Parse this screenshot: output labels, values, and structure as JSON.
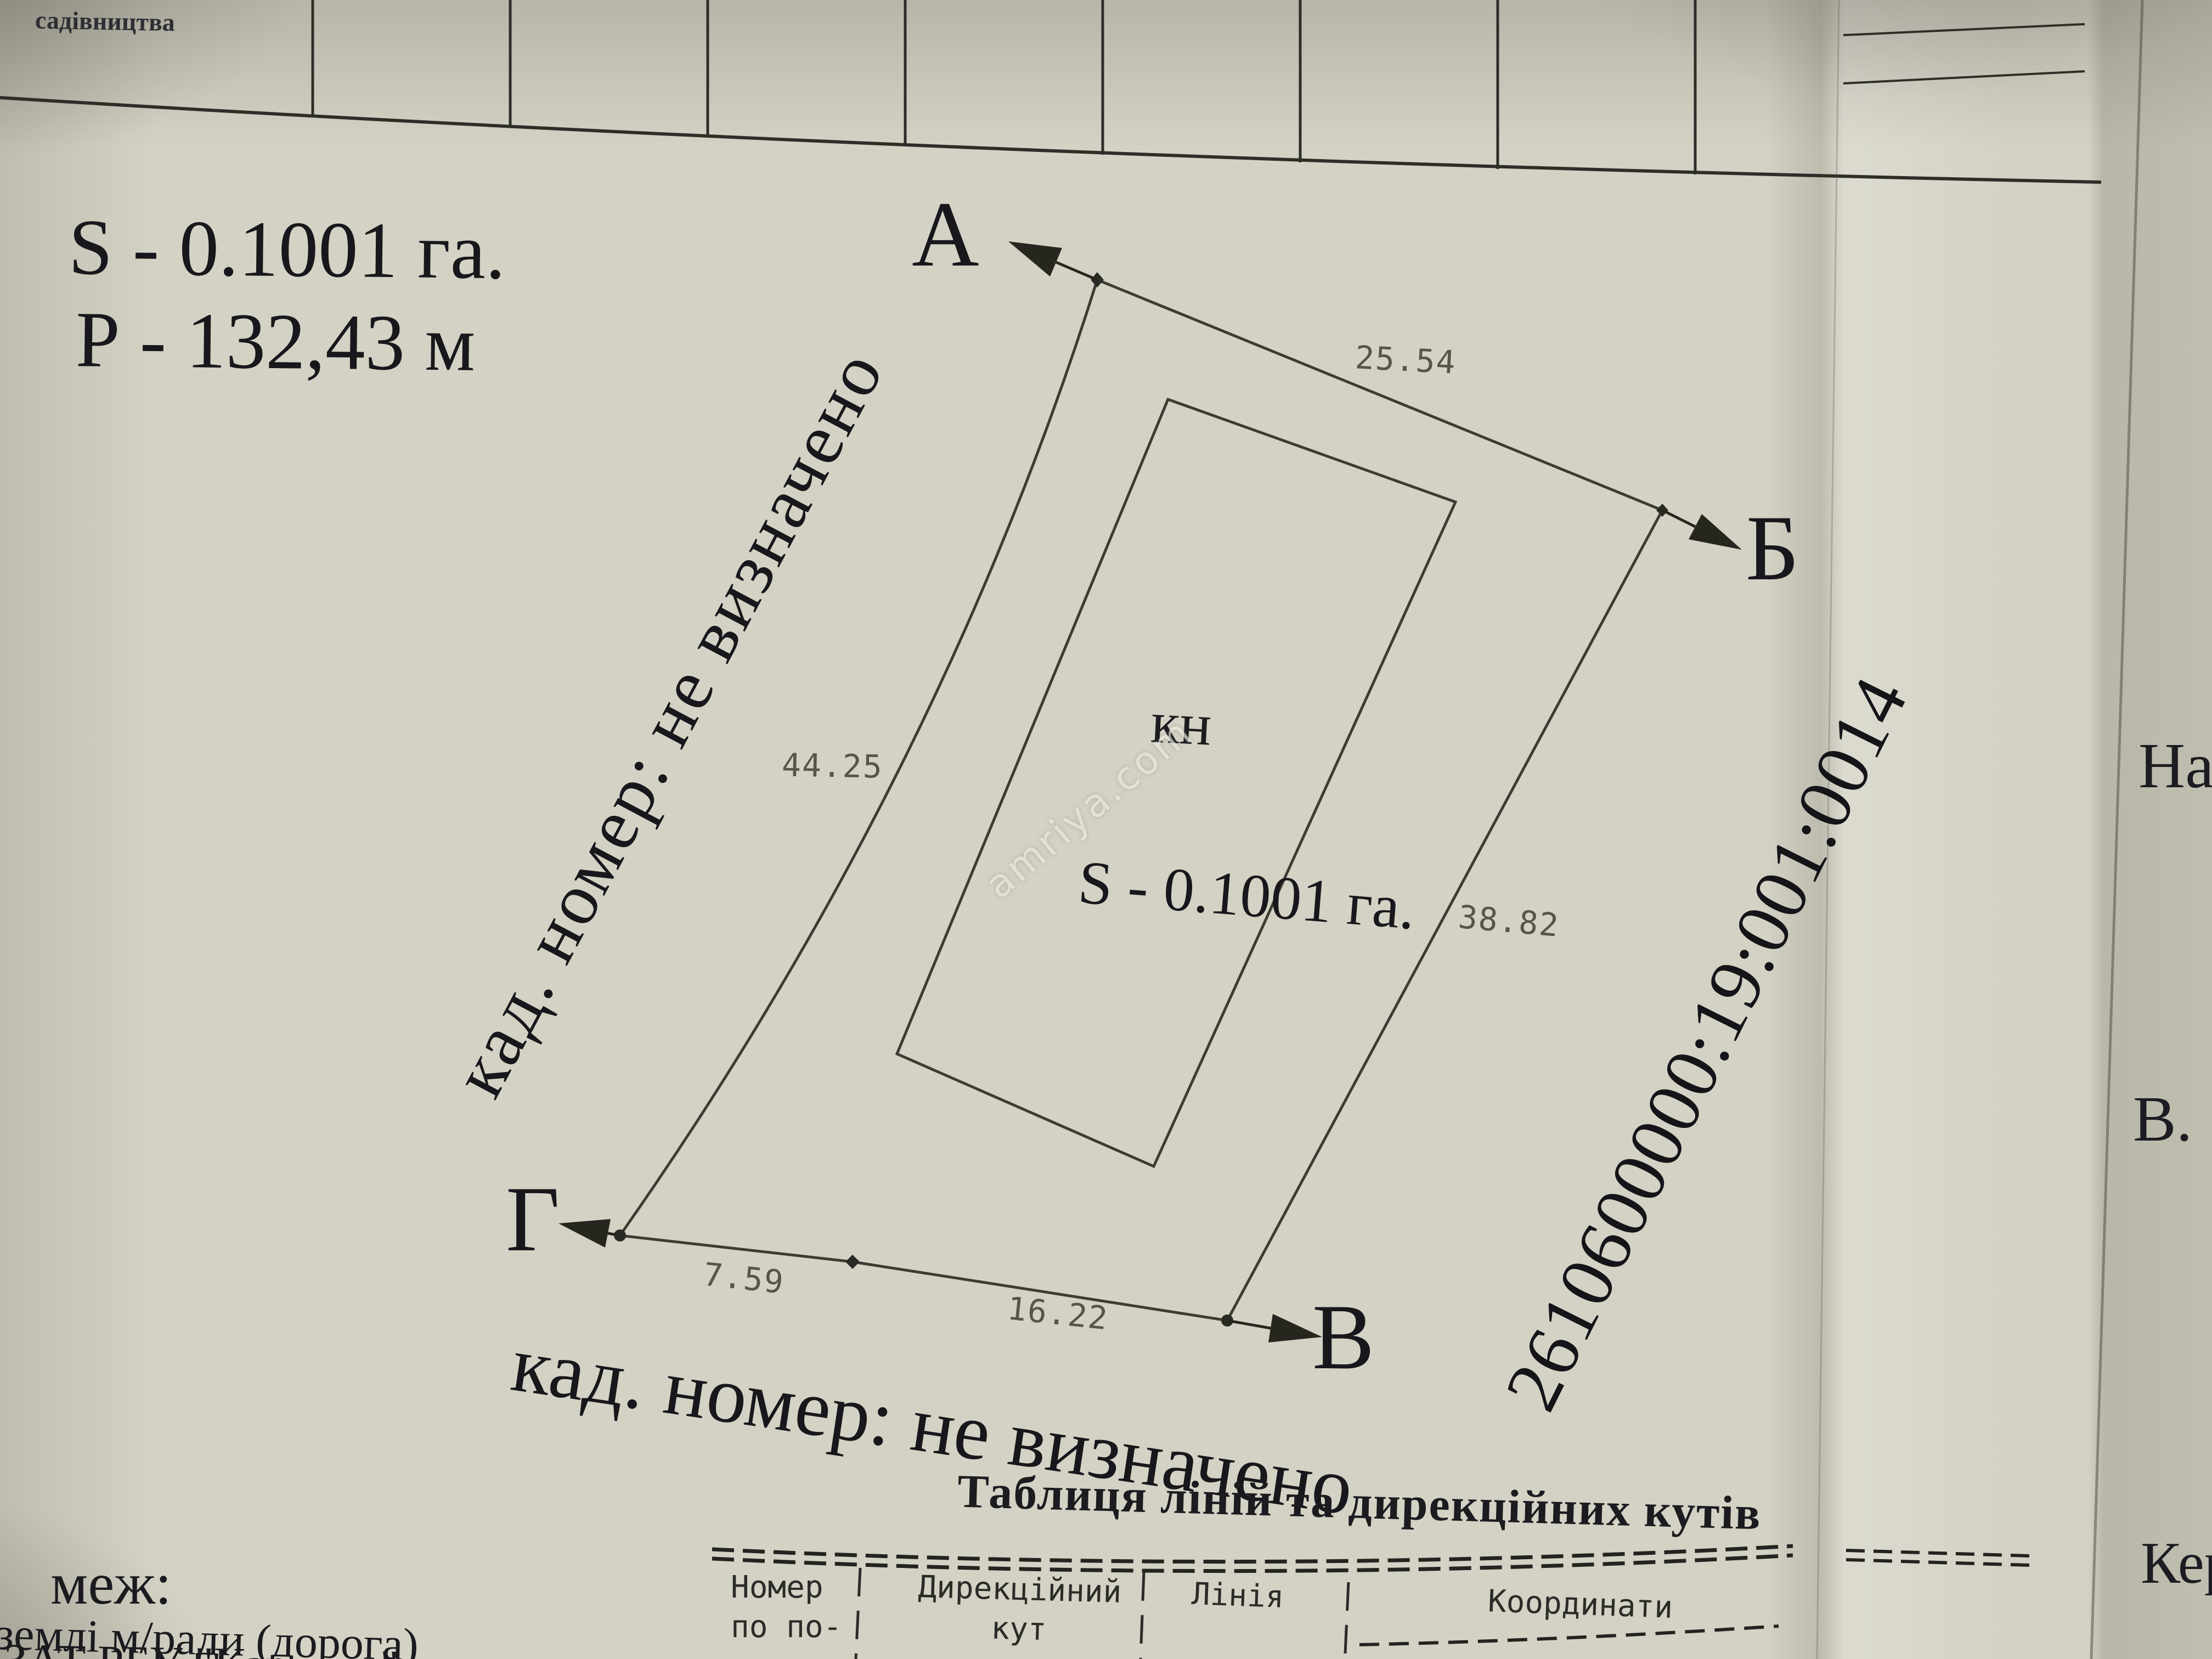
{
  "document": {
    "top_note": "садівництва",
    "area": "S - 0.1001 га.",
    "perimeter": "Р - 132,43 м",
    "watermark": "amriya.com"
  },
  "plot": {
    "vertex_a": "А",
    "vertex_b": "Б",
    "vertex_v": "В",
    "vertex_g": "Г",
    "len_ab": "25.54",
    "len_bv": "38.82",
    "len_vg_far": "16.22",
    "len_vg_near": "7.59",
    "len_ga": "44.25",
    "inner_label": "кн",
    "inner_area": "S - 0.1001 га.",
    "cadastral_number": "2610600000:19:001:0014",
    "left_boundary_note": "кад. номер: не визначено",
    "bottom_boundary_note": "кад. номер: не визначено"
  },
  "lines_table": {
    "title": "Таблиця ліній та дирекційних кутів",
    "col_number": "Номер\nпо по-\nрядку",
    "col_bearing": "Дирекційний\nкут",
    "col_line": "Лінія",
    "col_coords": "Координати"
  },
  "neighbors": {
    "label": "меж:",
    "item1": "землі м/ради (дорога)",
    "item2": "ЗАТ РБУ \"Карпати\""
  },
  "next_page": {
    "fragment1": "На",
    "fragment2": "В.",
    "fragment3": "Кер"
  }
}
